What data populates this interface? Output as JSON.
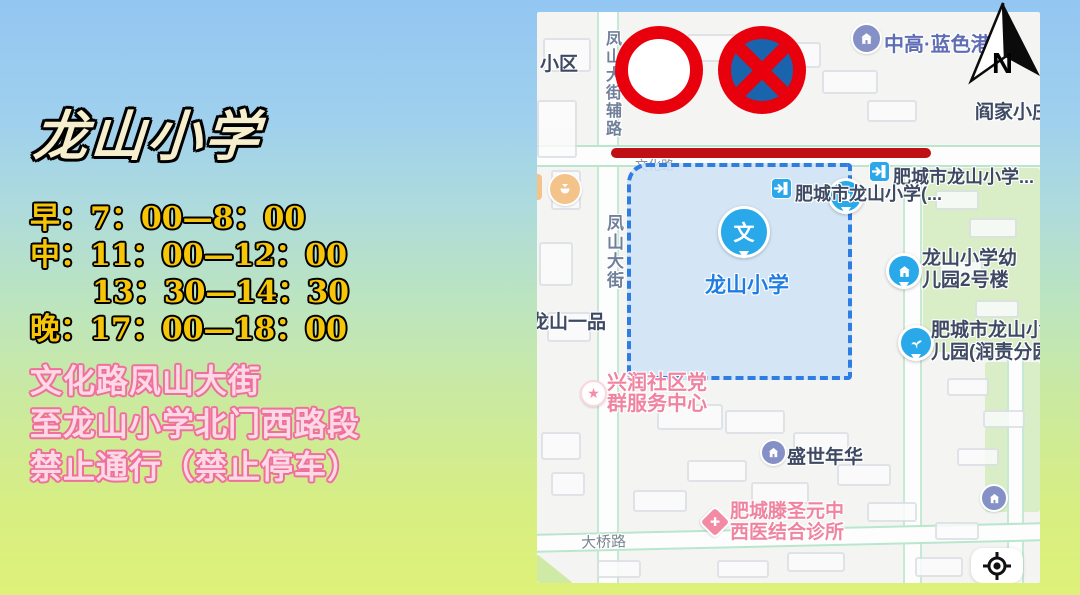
{
  "background": {
    "top_color": "#93c6f2",
    "bottom_color": "#def178"
  },
  "left_panel": {
    "title": "龙山小学",
    "schedule": [
      "早：7：00—8：00",
      "中：11：00—12：00",
      "13：30—14：30",
      "晚：17：00—18：00"
    ],
    "notice": [
      "文化路凤山大街",
      "至龙山小学北门西路段",
      "禁止通行（禁止停车）"
    ]
  },
  "map": {
    "compass_letter": "N",
    "labels": {
      "xiaoqu": "小区",
      "fengshan_aux_road": "凤山大街辅路",
      "fengshan_street": "凤山大街",
      "wenhua_road": "文化路",
      "zhonggao_langang": "中高·蓝色港湾",
      "yanjia_xiaozhuang": "阎家小庄",
      "school_gate_top": "肥城市龙山小学...",
      "school_gate_west": "肥城市龙山小学(...",
      "school": "龙山小学",
      "school_marker_glyph": "文",
      "longshan_yipin": "龙山一品",
      "kindergarten_no2": [
        "龙山小学幼",
        "儿园2号楼"
      ],
      "kindergarten_runze": [
        "肥城市龙山小",
        "儿园(润责分园"
      ],
      "xingrun_center": [
        "兴润社区党",
        "群服务中心"
      ],
      "shengshi_nianhua": "盛世年华",
      "clinic": [
        "肥城滕圣元中",
        "西医结合诊所"
      ],
      "daqiao_road": "大桥路"
    },
    "icons": {
      "star_glyph": "★",
      "cross_glyph": "✚"
    }
  },
  "colors": {
    "no_entry_red": "#e8000d",
    "no_stopping_blue": "#1a63ad",
    "restricted_line_red": "#bf1016",
    "zone_border_blue": "#2d7de2",
    "zone_fill_blue": "#cee3f6",
    "marker_blue": "#29a9e9",
    "school_label_blue": "#1e7de2",
    "pink_poi": "#ef84a0",
    "schedule_gold": "#f5c506",
    "notice_pink": "#fdd9e5"
  }
}
